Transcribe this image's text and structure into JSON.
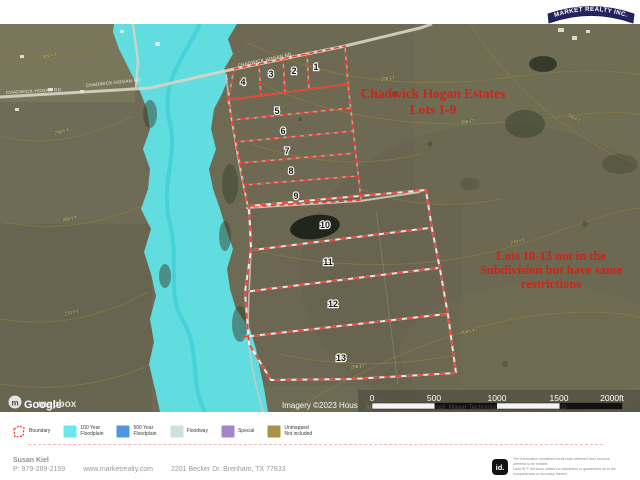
{
  "header": {
    "logo_text": "MARKET REALTY INC."
  },
  "map": {
    "title_lines": [
      "Chadwick Hogan Estates",
      "Lots 1-9"
    ],
    "note_lines": [
      "Lots 10-13 not in the",
      "Subdivision but have same",
      "restrictions"
    ],
    "lots": [
      "1",
      "2",
      "3",
      "4",
      "5",
      "6",
      "7",
      "8",
      "9",
      "10",
      "11",
      "12",
      "13"
    ],
    "road_labels": [
      "CHADWICK-HOGAN RD",
      "CHADWICK-HOGAN RD",
      "CHADWICK HOGAN RD"
    ],
    "contour_labels": [
      "300 FT",
      "290 FT",
      "280 FT",
      "270 FT",
      "290 FT",
      "280 FT",
      "270 FT",
      "260 FT",
      "300 FT",
      "260 FT"
    ],
    "watermark": {
      "google": "Google",
      "mapbox": "mapbox"
    },
    "attribution": "Imagery ©2023 Hous",
    "attribution_faint": "ton-Galveston Area Council, Maxar Technologies, USDA, FPAC, GEO",
    "scale_ticks": [
      "0",
      "500",
      "1000",
      "1500",
      "2000ft"
    ]
  },
  "legend": {
    "items": [
      {
        "label": "Boundary",
        "color": "none"
      },
      {
        "label": "100 Year\nFloodplain",
        "color": "#68e8ee"
      },
      {
        "label": "500 Year\nFloodplain",
        "color": "#4d97de"
      },
      {
        "label": "Floodway",
        "color": "#cfe0e3"
      },
      {
        "label": "Special",
        "color": "#a585c9"
      },
      {
        "label": "Unmapped\nNot included",
        "color": "#a8914a"
      }
    ]
  },
  "footer": {
    "agent_name": "Susan Kiel",
    "phone": "P: 979-289-2159",
    "website": "www.marketrealty.com",
    "address": "2201 Becker Dr. Brenham, TX 77833",
    "id_logo": "id.",
    "disclaimer": "The information contained herein was obtained from sources\ndeemed to be reliable.\nLand iD™ Services makes no warranties or guarantees as to the\ncompleteness or accuracy thereof."
  },
  "colors": {
    "boundary_red": "#e8352c",
    "annotation_red": "#cf2418",
    "floodplain_cyan": "#5fe6ec",
    "logo_navy": "#23235f"
  }
}
